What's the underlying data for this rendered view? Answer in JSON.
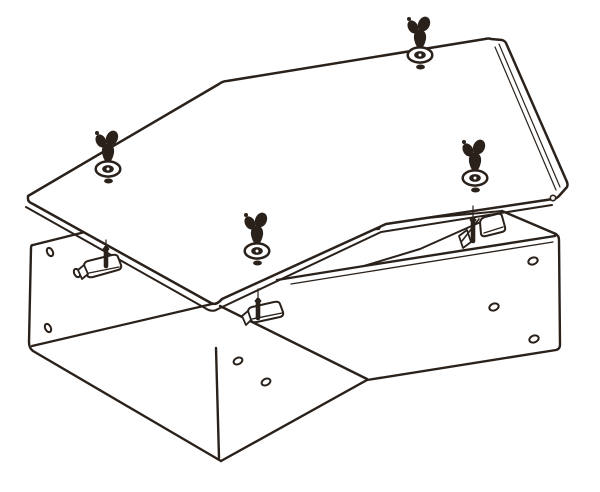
{
  "figure": {
    "kind": "exploded-technical-line-illustration",
    "subject": "45-degree offset duct / cable trunking body with cover plate, wing screws, washers and stud brackets",
    "background_color": "#ffffff",
    "line_color": "#2a211b",
    "canvas": {
      "width": 600,
      "height": 492
    },
    "parts": [
      {
        "name": "cover-plate",
        "count": 1
      },
      {
        "name": "wing-screw-with-washer",
        "count": 4
      },
      {
        "name": "duct-body",
        "count": 1
      },
      {
        "name": "stud-bracket",
        "count": 3
      },
      {
        "name": "side-wall-hole",
        "count": 8
      },
      {
        "name": "cover-rivet-hole",
        "count": 1
      }
    ]
  },
  "drawing": {
    "stroke_main": 2.4,
    "stroke_thin": 1.2,
    "body_paths": [
      {
        "n": "body-left-end-and-bottom-edge",
        "d": "M93,230 L33,245 Q31,245 31,248 L29,342 Q29,348 33,351 L221,461",
        "w": 2.4
      },
      {
        "n": "body-front-left-wall-end-edge",
        "d": "M216,348 L219,458",
        "w": 2.4
      },
      {
        "n": "body-inner-bottom-corner",
        "d": "M32,346 L212,304",
        "w": 2.2
      },
      {
        "n": "body-front-left-wall-top-edge",
        "d": "M220,306 L367,379",
        "w": 2.4
      },
      {
        "n": "body-bottom-front-edge-right",
        "d": "M221,461 L367,380 L556,350 Q560,349 560,345 L559,240 Q559,235 555,234",
        "w": 2.4
      },
      {
        "n": "body-right-end-top-edge",
        "d": "M556,234 L502,211",
        "w": 2.4
      },
      {
        "n": "body-back-right-wall-top-edge",
        "d": "M502,211 L383,222 L379,229 L353,231",
        "w": 2.0
      },
      {
        "n": "body-back-right-wall-inner-line",
        "d": "M503,212 L420,249 L364,266",
        "w": 2.0
      },
      {
        "n": "body-front-right-wall-top-edge",
        "d": "M555,236 L364,266 L277,280",
        "w": 2.4
      },
      {
        "n": "body-front-right-wall-flange-line",
        "d": "M553,242 L366,272 L291,284",
        "w": 1.3
      }
    ],
    "lid_paths": [
      {
        "n": "cover-outline",
        "d": "M28,196 L219,84 Q223,81 227,81 L485,39 Q489,38 491,39 L502,40 Q505,41 506,43 L567,182 Q568,185 567,187 L559,196 Q556,199 553,199 L386,224 L222,299 Q216,306 211,303 L33,204 Q28,202 28,199 Z",
        "w": 2.5,
        "f": "#ffffff"
      },
      {
        "n": "cover-front-flange-line",
        "d": "M26,207 L205,308 Q212,313 218,309 L381,232 L552,205",
        "w": 2.0
      },
      {
        "n": "cover-right-edge-inner-line-1",
        "d": "M495,47 L556,190",
        "w": 1.2
      },
      {
        "n": "cover-right-edge-inner-line-2",
        "d": "M499,44 L560,187",
        "w": 1.2
      }
    ],
    "rivet_hole": {
      "n": "cover-rivet-hole",
      "cx": 553,
      "cy": 198,
      "r": 2.7,
      "w": 1.6
    },
    "holes": [
      {
        "n": "hole-back-wall-1",
        "cx": 50,
        "cy": 252,
        "rx": 4.4,
        "ry": 2.8,
        "rot": 64,
        "w": 2.0
      },
      {
        "n": "hole-back-wall-2",
        "cx": 77,
        "cy": 273,
        "rx": 4.4,
        "ry": 2.8,
        "rot": 64,
        "w": 2.0
      },
      {
        "n": "hole-back-wall-3",
        "cx": 48,
        "cy": 328,
        "rx": 4.4,
        "ry": 2.8,
        "rot": 64,
        "w": 2.0
      },
      {
        "n": "hole-front-left-wall-1",
        "cx": 238,
        "cy": 361,
        "rx": 4.6,
        "ry": 3.2,
        "rot": -25,
        "w": 2.0
      },
      {
        "n": "hole-front-left-wall-2",
        "cx": 266,
        "cy": 382,
        "rx": 4.6,
        "ry": 3.2,
        "rot": -25,
        "w": 2.0
      },
      {
        "n": "hole-front-right-wall-1",
        "cx": 533,
        "cy": 261,
        "rx": 4.8,
        "ry": 3.4,
        "rot": -20,
        "w": 2.0
      },
      {
        "n": "hole-front-right-wall-2",
        "cx": 494,
        "cy": 307,
        "rx": 4.8,
        "ry": 3.4,
        "rot": -20,
        "w": 2.0
      },
      {
        "n": "hole-front-right-wall-3",
        "cx": 534,
        "cy": 339,
        "rx": 4.8,
        "ry": 3.4,
        "rot": -20,
        "w": 2.0
      }
    ],
    "studs": [
      {
        "n": "stud-bracket-left",
        "pin": [
          106,
          248,
          106,
          266
        ],
        "align": [
          106,
          240,
          106,
          247
        ],
        "bracket": "M84,266 Q84,262 88,261 L112,255 Q117,254 118,257 L121,265 Q122,269 118,270 L93,277 Q88,278 87,275 Z",
        "inner": "M89,273 L119,267",
        "foot": "M78,270 L84,265 L88,274 L82,279 Z"
      },
      {
        "n": "stud-bracket-middle",
        "pin": [
          258,
          300,
          258,
          318
        ],
        "align": [
          258,
          289,
          258,
          299
        ],
        "bracket": "M248,312 Q248,308 252,307 L274,302 Q279,301 280,304 L283,312 Q284,316 280,317 L257,322 Q252,323 251,320 Z",
        "inner": "M252,319 L282,313",
        "foot": "M242,316 L248,311 L251,320 L246,325 Z"
      },
      {
        "n": "stud-bracket-right",
        "pin": [
          473,
          219,
          473,
          241
        ],
        "align": [
          473,
          206,
          473,
          218
        ],
        "bracket": "M480,222 Q481,218 485,217 L497,214 Q501,213 502,216 L505,227 Q506,231 502,232 L486,236 Q482,237 481,234 Z",
        "inner": "M484,233 L503,227",
        "foot": "M459,236 L467,230 L471,242 L463,248 Z",
        "brace": "M479,219 L462,241"
      }
    ],
    "wing_screws": [
      {
        "n": "wing-screw-left",
        "cx": 108,
        "cy": 169
      },
      {
        "n": "wing-screw-top",
        "cx": 420,
        "cy": 55
      },
      {
        "n": "wing-screw-middle",
        "cx": 257,
        "cy": 251
      },
      {
        "n": "wing-screw-right",
        "cx": 475,
        "cy": 178
      }
    ],
    "wing_template": {
      "ear1": {
        "dx": -7,
        "dy": -28,
        "rx": 5.0,
        "ry": 7.0,
        "rot": -30
      },
      "ear2": {
        "dx": 4,
        "dy": -31,
        "rx": 5.8,
        "ry": 7.6,
        "rot": 25
      },
      "hub": {
        "dx": -1,
        "dy": -20,
        "rx": 4.6,
        "ry": 5.0,
        "rot": 0
      },
      "tip_dot": {
        "dx": -11,
        "dy": -36,
        "r": 2.0
      },
      "cone": "M-6,-16 Q-7,-24 0,-26 Q7,-24 6,-16 Q4,-7 0,-6 Q-4,-7 -6,-16 Z",
      "washer": {
        "rx": 12.3,
        "ry": 7.6,
        "w": 2.5
      },
      "washer_ring": {
        "rx": 5.8,
        "ry": 3.9
      },
      "washer_pinhole_r": 1.5,
      "stem_dot": {
        "dx": 0.5,
        "dy": 12,
        "rx": 4.4,
        "ry": 2.5
      }
    }
  }
}
